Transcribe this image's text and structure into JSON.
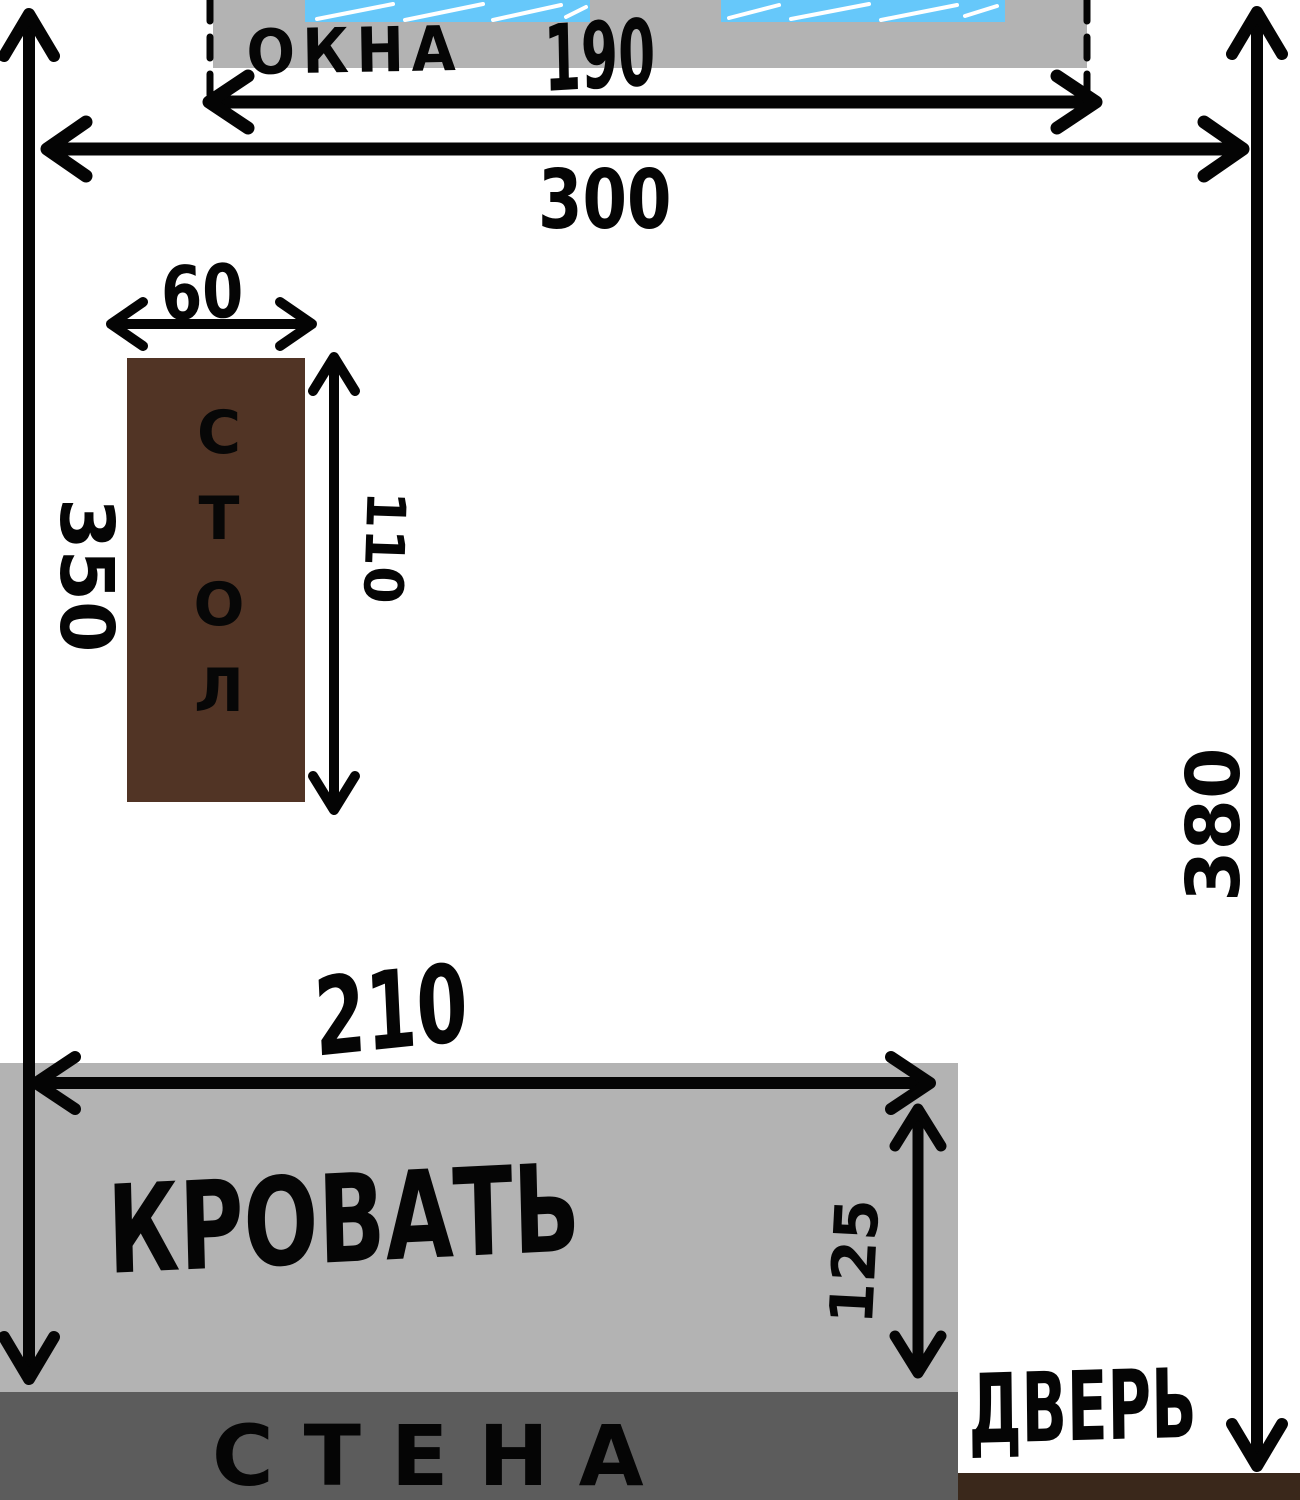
{
  "room": {
    "windows_label": "ОКНА",
    "table_label": "СТОЛ",
    "bed_label": "КРОВАТЬ",
    "wall_label": "СТЕНА",
    "door_label": "ДВЕРЬ"
  },
  "dimensions": {
    "windows_width": "190",
    "room_width": "300",
    "left_wall_height": "350",
    "right_wall_height": "380",
    "table_width": "60",
    "table_length": "110",
    "bed_length": "210",
    "bed_width": "125"
  },
  "colors": {
    "wall_light_gray": "#b3b3b3",
    "wall_dark_gray": "#5c5c5c",
    "window_blue": "#66c8fa",
    "table_brown": "#513425",
    "door_wall_brown": "#3a281b",
    "ink_black": "#040404"
  }
}
